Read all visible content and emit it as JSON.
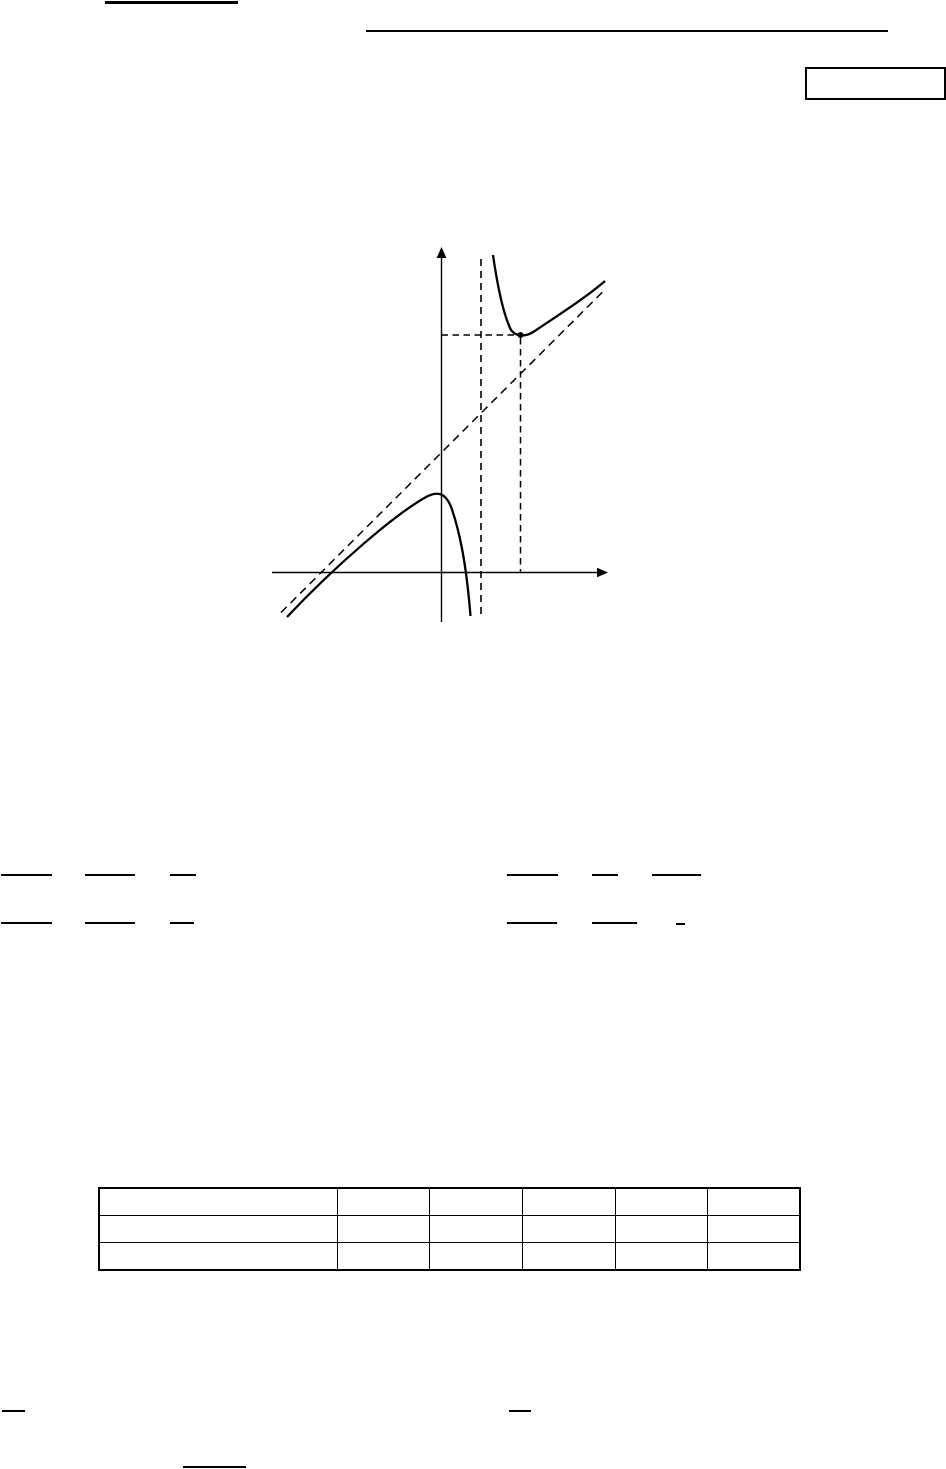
{
  "page": {
    "kind": "printed-math-document-page",
    "background_color": "#ffffff",
    "ink_color": "#000000",
    "note": "No text glyphs are rendered on this page; only horizontal rules, an empty answer box, an unlabeled function sketch, fraction bars and an empty 3x6 table are visible."
  },
  "marks": {
    "rules": [
      {
        "name": "title-underline",
        "x": 105,
        "y": 1,
        "w": 133,
        "h": 2.5
      },
      {
        "name": "header-rule",
        "x": 366,
        "y": 30,
        "w": 522,
        "h": 2
      },
      {
        "name": "fraction-bar",
        "x": 1,
        "y": 874,
        "w": 51,
        "h": 2
      },
      {
        "name": "fraction-bar",
        "x": 85,
        "y": 874,
        "w": 50,
        "h": 2
      },
      {
        "name": "fraction-bar",
        "x": 170,
        "y": 874,
        "w": 26,
        "h": 2
      },
      {
        "name": "fraction-bar",
        "x": 507,
        "y": 874,
        "w": 51,
        "h": 2
      },
      {
        "name": "fraction-bar",
        "x": 592,
        "y": 874,
        "w": 26,
        "h": 2
      },
      {
        "name": "fraction-bar",
        "x": 652,
        "y": 874,
        "w": 49,
        "h": 2
      },
      {
        "name": "fraction-bar",
        "x": 1,
        "y": 922,
        "w": 51,
        "h": 2
      },
      {
        "name": "fraction-bar",
        "x": 85,
        "y": 922,
        "w": 50,
        "h": 2
      },
      {
        "name": "fraction-bar",
        "x": 170,
        "y": 922,
        "w": 24,
        "h": 2
      },
      {
        "name": "fraction-bar",
        "x": 507,
        "y": 922,
        "w": 50,
        "h": 2
      },
      {
        "name": "fraction-bar",
        "x": 592,
        "y": 922,
        "w": 45,
        "h": 2
      },
      {
        "name": "fraction-bar",
        "x": 676,
        "y": 923,
        "w": 9,
        "h": 2
      },
      {
        "name": "footer-bar",
        "x": 2,
        "y": 1410,
        "w": 23,
        "h": 2
      },
      {
        "name": "footer-bar",
        "x": 509,
        "y": 1410,
        "w": 22,
        "h": 2
      },
      {
        "name": "footer-bar",
        "x": 183,
        "y": 1466,
        "w": 63,
        "h": 2
      }
    ]
  },
  "answer_box": {
    "x": 805,
    "y": 67,
    "w": 141,
    "h": 33,
    "value": ""
  },
  "figure": {
    "type": "function-sketch",
    "x": 266,
    "y": 240,
    "w": 348,
    "h": 388,
    "features": {
      "axes": "unlabeled x-axis and y-axis with arrowheads",
      "curve": "two-branch curve of a rational function",
      "left_branch": "rises from lower left along the oblique asymptote, local maximum on the y-axis, falls to minus infinity at the vertical asymptote",
      "right_branch": "falls from plus infinity right of the vertical asymptote down to a marked local minimum, then rises along the oblique asymptote",
      "vertical_asymptote": "dashed vertical line right of the y-axis",
      "oblique_asymptote": "dashed line of slope about +1",
      "minimum_point": "solid dot with dashed projections onto both axes"
    }
  },
  "table": {
    "x": 98,
    "y": 1187,
    "w": 701,
    "rows": 3,
    "cols": 6,
    "col_widths": [
      238,
      92,
      93,
      93,
      92,
      93
    ],
    "row_height": 28,
    "cells": [
      [
        "",
        "",
        "",
        "",
        "",
        ""
      ],
      [
        "",
        "",
        "",
        "",
        "",
        ""
      ],
      [
        "",
        "",
        "",
        "",
        "",
        ""
      ]
    ]
  }
}
